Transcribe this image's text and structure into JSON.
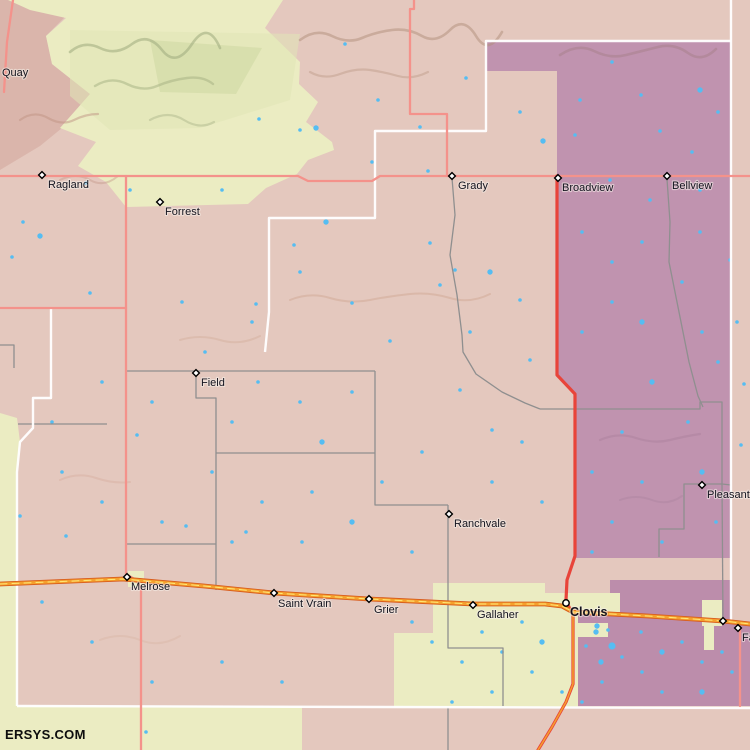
{
  "site": {
    "watermark": "ERSYS.COM"
  },
  "colors": {
    "base": "#e4c8be",
    "mauve": "#dab5ab",
    "yellow": "#ebecc2",
    "yellowGreen": "#e0e5b6",
    "greenClump": "#ccd5a0",
    "purple": "#c093af",
    "purpleB": "#bc8dab",
    "water": "#55bdf2",
    "roadMinor": "#f4928b",
    "roadRed": "#e8443a",
    "hwyOutline": "#d85c1c",
    "hwyFill": "#f5a02d",
    "hwyCenter": "#ffe878",
    "gray": "#8f8f8f",
    "white": "#ffffff",
    "labelColor": "#14141f"
  },
  "map": {
    "width": 750,
    "height": 750,
    "regions": [
      {
        "name": "quay-mauve-region",
        "fill": "mauve",
        "points": "0,0 64,0 64,18 46,36 52,64 90,94 62,128 40,146 20,158 0,170"
      },
      {
        "name": "caprock-yellow-region",
        "fill": "yellow",
        "points": "8,0 283,0 265,28 300,62 299,84 318,102 306,122 332,142 334,150 308,160 297,174 266,188 248,204 126,207 106,182 78,166 96,142 60,128 90,94 52,64 46,36 66,18 30,10"
      },
      {
        "name": "yellow-green-shade",
        "fill": "yellowGreen",
        "opacity": 0.55,
        "points": "70,30 300,34 290,100 200,128 110,130 70,96"
      },
      {
        "name": "green-clump",
        "fill": "greenClump",
        "opacity": 0.5,
        "points": "150,40 262,48 236,94 160,92"
      },
      {
        "name": "purple-region-main",
        "fill": "purple",
        "points": "486,41 731,41 731,558 575,558 575,393 557,375 557,71 486,71"
      },
      {
        "name": "purple-region-clovis",
        "fill": "purpleB",
        "points": "610,580 731,580 731,620 750,622 750,706 578,706 578,613 610,613"
      },
      {
        "name": "left-yellow-strip",
        "fill": "yellow",
        "points": "0,413 17,418 20,442 17,472 17,750 0,750"
      },
      {
        "name": "bottom-yellow-region",
        "fill": "yellow",
        "points": "17,706 302,706 302,750 17,750"
      },
      {
        "name": "clovis-yellow-region",
        "fill": "yellow",
        "points": "433,583 545,583 545,593 620,593 620,612 578,612 578,707 394,707 394,633 433,633"
      },
      {
        "name": "yellow-notch",
        "fill": "yellow",
        "points": "578,623 608,623 608,637 578,637"
      },
      {
        "name": "texico-yellow-strip",
        "fill": "yellow",
        "points": "702,600 722,600 722,626 714,626 714,650 704,650 704,626 702,626"
      },
      {
        "name": "melrose-yellow-patch",
        "fill": "yellow",
        "points": "128,571 144,571 144,587 128,587"
      }
    ],
    "ridges": [
      {
        "d": "M70,52 q14,-12 30,-4 t32,-4 t30,6 t30,-6 t28,4",
        "stroke": "#a4af82",
        "w": 2.6,
        "o": 0.6
      },
      {
        "d": "M95,86 q16,-10 32,-2 t30,2 t30,-8 t26,6",
        "stroke": "#a4af82",
        "w": 2.4,
        "o": 0.5
      },
      {
        "d": "M150,120 q18,-10 34,0 t30,2",
        "stroke": "#a9b489",
        "w": 2.2,
        "o": 0.45
      },
      {
        "d": "M300,40 q16,-12 32,-4 t30,2 t30,-8 t30,6 t28,-6 t26,6 t26,-4",
        "stroke": "#b08d7a",
        "w": 2.6,
        "o": 0.5
      },
      {
        "d": "M310,72 q14,8 30,2 t30,-4 t28,6 t30,-4",
        "stroke": "#b6937f",
        "w": 2.2,
        "o": 0.4
      },
      {
        "d": "M560,55 q18,-12 34,-4 t32,4 t32,-8 t30,6 t28,-4",
        "stroke": "#a8818d",
        "w": 2.6,
        "o": 0.55
      },
      {
        "d": "M20,120 q14,-10 28,-2 t26,2 t24,-6",
        "stroke": "#c09384",
        "w": 2.2,
        "o": 0.5
      },
      {
        "d": "M60,180 q16,-8 30,0 t28,-4",
        "stroke": "#c09384",
        "w": 2,
        "o": 0.4
      },
      {
        "d": "M290,300 q20,-8 40,-2 t40,2 t40,-6 t40,4 t40,-4",
        "stroke": "#cfa591",
        "w": 2,
        "o": 0.45
      },
      {
        "d": "M180,340 q20,-6 40,0 t40,-4",
        "stroke": "#cfa591",
        "w": 2,
        "o": 0.35
      },
      {
        "d": "M600,440 q18,-8 36,-2 t34,2 t30,-6",
        "stroke": "#ab829d",
        "w": 2.2,
        "o": 0.5
      },
      {
        "d": "M620,500 q16,-6 32,0 t30,-4",
        "stroke": "#ab829d",
        "w": 2,
        "o": 0.4
      },
      {
        "d": "M60,480 q18,-8 36,-2 t34,4",
        "stroke": "#d4ab9b",
        "w": 2,
        "o": 0.4
      },
      {
        "d": "M100,640 q20,-8 40,0 t40,-4",
        "stroke": "#d9b5a6",
        "w": 2,
        "o": 0.45
      }
    ],
    "water": [
      [
        345,
        44,
        2
      ],
      [
        300,
        130,
        2
      ],
      [
        378,
        100,
        2
      ],
      [
        420,
        127,
        2
      ],
      [
        466,
        78,
        2
      ],
      [
        520,
        112,
        2
      ],
      [
        543,
        141,
        3
      ],
      [
        372,
        162,
        2
      ],
      [
        428,
        171,
        2
      ],
      [
        316,
        128,
        3
      ],
      [
        259,
        119,
        2
      ],
      [
        222,
        190,
        2
      ],
      [
        130,
        190,
        2
      ],
      [
        86,
        183,
        2
      ],
      [
        23,
        222,
        2
      ],
      [
        40,
        236,
        3
      ],
      [
        12,
        257,
        2
      ],
      [
        90,
        293,
        2
      ],
      [
        182,
        302,
        2
      ],
      [
        256,
        304,
        2
      ],
      [
        294,
        245,
        2
      ],
      [
        326,
        222,
        3
      ],
      [
        430,
        243,
        2
      ],
      [
        455,
        270,
        2
      ],
      [
        490,
        272,
        3
      ],
      [
        520,
        300,
        2
      ],
      [
        470,
        332,
        2
      ],
      [
        440,
        285,
        2
      ],
      [
        390,
        341,
        2
      ],
      [
        352,
        303,
        2
      ],
      [
        300,
        272,
        2
      ],
      [
        252,
        322,
        2
      ],
      [
        205,
        352,
        2
      ],
      [
        352,
        392,
        2
      ],
      [
        300,
        402,
        2
      ],
      [
        258,
        382,
        2
      ],
      [
        322,
        442,
        3
      ],
      [
        232,
        422,
        2
      ],
      [
        212,
        472,
        2
      ],
      [
        262,
        502,
        2
      ],
      [
        312,
        492,
        2
      ],
      [
        382,
        482,
        2
      ],
      [
        422,
        452,
        2
      ],
      [
        352,
        522,
        3
      ],
      [
        302,
        542,
        2
      ],
      [
        232,
        542,
        2
      ],
      [
        162,
        522,
        2
      ],
      [
        102,
        502,
        2
      ],
      [
        62,
        472,
        2
      ],
      [
        152,
        402,
        2
      ],
      [
        102,
        382,
        2
      ],
      [
        52,
        422,
        2
      ],
      [
        492,
        482,
        2
      ],
      [
        522,
        442,
        2
      ],
      [
        542,
        502,
        2
      ],
      [
        412,
        552,
        2
      ],
      [
        492,
        430,
        2
      ],
      [
        460,
        390,
        2
      ],
      [
        530,
        360,
        2
      ],
      [
        137,
        435,
        2
      ],
      [
        186,
        526,
        2
      ],
      [
        246,
        532,
        2
      ],
      [
        20,
        516,
        2
      ],
      [
        66,
        536,
        2
      ],
      [
        146,
        732,
        2
      ],
      [
        42,
        602,
        2
      ],
      [
        92,
        642,
        2
      ],
      [
        152,
        682,
        2
      ],
      [
        222,
        662,
        2
      ],
      [
        282,
        682,
        2
      ],
      [
        580,
        100,
        2
      ],
      [
        612,
        62,
        2
      ],
      [
        641,
        95,
        2
      ],
      [
        700,
        90,
        3
      ],
      [
        660,
        131,
        2
      ],
      [
        692,
        152,
        2
      ],
      [
        718,
        112,
        2
      ],
      [
        575,
        135,
        2
      ],
      [
        610,
        180,
        2
      ],
      [
        650,
        200,
        2
      ],
      [
        700,
        190,
        2
      ],
      [
        582,
        232,
        2
      ],
      [
        612,
        262,
        2
      ],
      [
        642,
        242,
        2
      ],
      [
        700,
        232,
        2
      ],
      [
        682,
        282,
        2
      ],
      [
        642,
        322,
        3
      ],
      [
        612,
        302,
        2
      ],
      [
        582,
        332,
        2
      ],
      [
        702,
        332,
        2
      ],
      [
        718,
        362,
        2
      ],
      [
        652,
        382,
        3
      ],
      [
        688,
        422,
        2
      ],
      [
        622,
        432,
        2
      ],
      [
        592,
        472,
        2
      ],
      [
        642,
        482,
        2
      ],
      [
        702,
        472,
        3
      ],
      [
        716,
        522,
        2
      ],
      [
        662,
        542,
        2
      ],
      [
        612,
        522,
        2
      ],
      [
        592,
        552,
        2
      ],
      [
        730,
        260,
        2
      ],
      [
        737,
        322,
        2
      ],
      [
        744,
        384,
        2
      ],
      [
        741,
        445,
        2
      ],
      [
        596,
        632,
        3
      ],
      [
        612,
        646,
        4
      ],
      [
        601,
        662,
        3
      ],
      [
        622,
        657,
        2
      ],
      [
        586,
        646,
        2
      ],
      [
        641,
        632,
        2
      ],
      [
        662,
        652,
        3
      ],
      [
        682,
        642,
        2
      ],
      [
        702,
        662,
        2
      ],
      [
        722,
        652,
        2
      ],
      [
        642,
        672,
        2
      ],
      [
        602,
        682,
        2
      ],
      [
        662,
        692,
        2
      ],
      [
        702,
        692,
        3
      ],
      [
        732,
        672,
        2
      ],
      [
        582,
        702,
        2
      ],
      [
        522,
        622,
        2
      ],
      [
        542,
        642,
        3
      ],
      [
        502,
        652,
        2
      ],
      [
        462,
        662,
        2
      ],
      [
        482,
        632,
        2
      ],
      [
        432,
        642,
        2
      ],
      [
        412,
        622,
        2
      ],
      [
        532,
        672,
        2
      ],
      [
        562,
        692,
        2
      ],
      [
        492,
        692,
        2
      ],
      [
        452,
        702,
        2
      ],
      [
        597,
        626,
        3
      ],
      [
        608,
        630,
        2
      ]
    ],
    "gray_lines": [
      "452,178 455,215 450,255 457,295 462,335 463,352 476,374 502,392 525,403 540,409",
      "540,409 700,409 700,402 722,402 722,484",
      "722,484 684,484 684,529 659,529 659,557",
      "722,484 731,485",
      "722,484 723,621",
      "667,179 670,222 669,262 677,302 689,362 698,396 703,407",
      "125,371 375,371",
      "375,371 375,505 448,505",
      "448,505 448,648 503,648 503,706",
      "448,707 448,750",
      "196,371 196,398 216,398 216,590",
      "216,453 375,453",
      "127,544 216,544",
      "18,424 107,424",
      "0,345 14,345 14,368"
    ],
    "white_lines": [
      "731,0 731,621",
      "265,352 269,312 269,218 375,218 375,131 486,131 486,41 731,41",
      "51,308 51,398 33,398 33,428 20,442 17,472 17,706",
      "17,706 750,708"
    ],
    "roads": [
      {
        "name": "east-west-road-ragland-grady",
        "type": "minor",
        "points": "0,176 298,176 308,181 372,181 380,176 750,176"
      },
      {
        "name": "north-south-road-west",
        "type": "minor",
        "points": "126,176 126,574 136,580 141,588 141,750"
      },
      {
        "name": "road-grady-north",
        "type": "minor",
        "points": "414,0 414,9 410,9 410,114 447,114 447,176"
      },
      {
        "name": "west-spur-road",
        "type": "minor",
        "points": "0,308 126,308"
      },
      {
        "name": "nw-corner-road",
        "type": "minor",
        "points": "13,0 7,42 4,92"
      },
      {
        "name": "farwell-south-road",
        "type": "minor",
        "points": "740,629 740,706"
      },
      {
        "name": "broadview-clovis-road",
        "type": "red",
        "points": "557,176 557,375 575,394 575,556 567,580 566,600 569,607 573,613 573,684 566,702 552,727 538,750"
      },
      {
        "name": "us-60-84-highway",
        "type": "highway",
        "points": "0,584 123,579 204,586 274,593 369,599 473,604 545,604 562,606 573,612 648,616 723,621 750,624"
      },
      {
        "name": "us-60-84-south-branch",
        "type": "redCenter",
        "points": "573,613 573,684 566,702 552,727 538,750"
      }
    ],
    "extra_markers": [
      [
        723,
        621
      ]
    ],
    "towns": [
      {
        "label": "Quay",
        "x": -6,
        "y": 68,
        "marker": "none",
        "dx": 8,
        "dy": 8
      },
      {
        "label": "Ragland",
        "x": 42,
        "y": 175,
        "marker": "diamond",
        "dx": 6,
        "dy": 13
      },
      {
        "label": "Forrest",
        "x": 160,
        "y": 202,
        "marker": "diamond",
        "dx": 5,
        "dy": 13
      },
      {
        "label": "Grady",
        "x": 452,
        "y": 176,
        "marker": "diamond",
        "dx": 6,
        "dy": 13
      },
      {
        "label": "Broadview",
        "x": 558,
        "y": 178,
        "marker": "diamond",
        "dx": 4,
        "dy": 13
      },
      {
        "label": "Bellview",
        "x": 667,
        "y": 176,
        "marker": "diamond",
        "dx": 5,
        "dy": 13
      },
      {
        "label": "Field",
        "x": 196,
        "y": 373,
        "marker": "diamond",
        "dx": 5,
        "dy": 13
      },
      {
        "label": "Ranchvale",
        "x": 449,
        "y": 514,
        "marker": "diamond",
        "dx": 5,
        "dy": 13
      },
      {
        "label": "Pleasant Hill",
        "x": 702,
        "y": 485,
        "marker": "diamond",
        "dx": 5,
        "dy": 13
      },
      {
        "label": "Melrose",
        "x": 127,
        "y": 577,
        "marker": "diamond",
        "dx": 4,
        "dy": 13
      },
      {
        "label": "Saint Vrain",
        "x": 274,
        "y": 593,
        "marker": "diamond",
        "dx": 4,
        "dy": 14
      },
      {
        "label": "Grier",
        "x": 369,
        "y": 599,
        "marker": "diamond",
        "dx": 5,
        "dy": 14
      },
      {
        "label": "Gallaher",
        "x": 473,
        "y": 605,
        "marker": "diamond",
        "dx": 4,
        "dy": 13
      },
      {
        "label": "Clovis",
        "x": 566,
        "y": 603,
        "marker": "circle",
        "bold": true,
        "dx": 4,
        "dy": 13
      },
      {
        "label": "Farwell",
        "x": 738,
        "y": 628,
        "marker": "diamond",
        "dx": 4,
        "dy": 13
      }
    ]
  }
}
